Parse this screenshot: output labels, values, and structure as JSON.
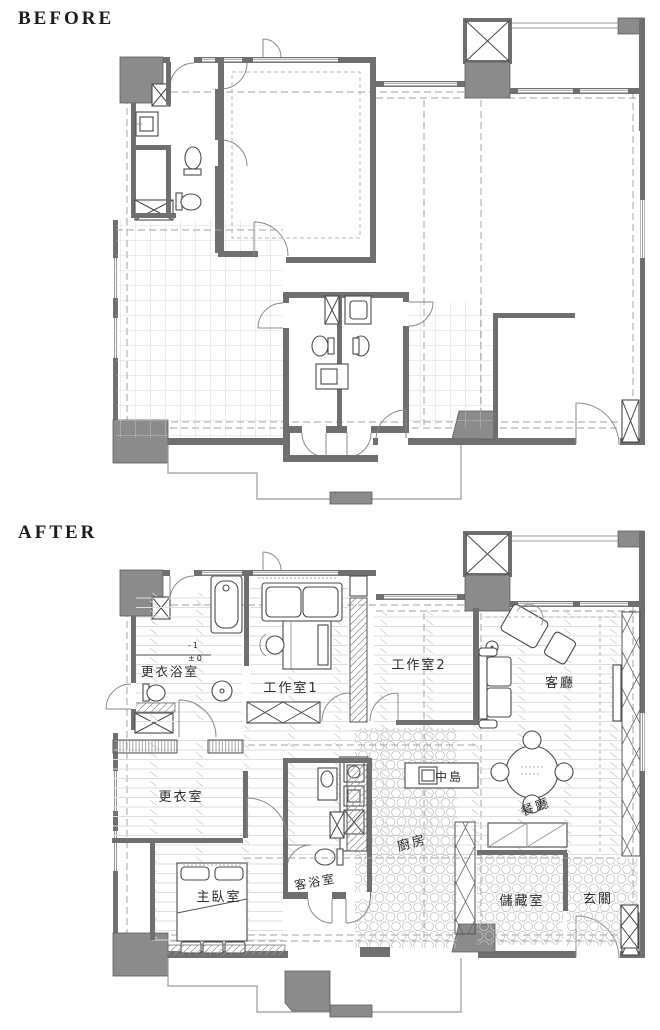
{
  "titles": {
    "before": "BEFORE",
    "after": "AFTER"
  },
  "after_plan": {
    "room_labels": [
      {
        "id": "dressing-bathroom",
        "label": "更衣浴室",
        "x": 170,
        "y": 676,
        "size": 12.5
      },
      {
        "id": "studio-1",
        "label": "工作室1",
        "x": 291,
        "y": 692,
        "size": 13
      },
      {
        "id": "studio-2",
        "label": "工作室2",
        "x": 419,
        "y": 669,
        "size": 13
      },
      {
        "id": "living-room",
        "label": "客廳",
        "x": 560,
        "y": 687,
        "size": 13
      },
      {
        "id": "dressing-room",
        "label": "更衣室",
        "x": 181,
        "y": 801,
        "size": 13
      },
      {
        "id": "island",
        "label": "中島",
        "x": 449,
        "y": 781,
        "size": 12
      },
      {
        "id": "dining-room",
        "label": "餐廳",
        "x": 537,
        "y": 811,
        "size": 13,
        "rotate": -20
      },
      {
        "id": "kitchen",
        "label": "廚房",
        "x": 413,
        "y": 847,
        "size": 13,
        "rotate": -15
      },
      {
        "id": "master-bedroom",
        "label": "主臥室",
        "x": 219,
        "y": 901,
        "size": 13
      },
      {
        "id": "guest-bathroom",
        "label": "客浴室",
        "x": 316,
        "y": 886,
        "size": 12,
        "rotate": -10
      },
      {
        "id": "storage-room",
        "label": "儲藏室",
        "x": 522,
        "y": 905,
        "size": 13
      },
      {
        "id": "entrance",
        "label": "玄關",
        "x": 598,
        "y": 903,
        "size": 13
      }
    ],
    "level_markers": [
      {
        "id": "level-minus-1",
        "label": "-1",
        "x": 194,
        "y": 648,
        "size": 8
      },
      {
        "id": "level-zero",
        "label": "±0",
        "x": 196,
        "y": 661,
        "size": 8
      }
    ]
  },
  "colors": {
    "wall": "#6f6f6f",
    "block": "#8b8b8b",
    "line": "#555555",
    "dashed": "#a3a3a3",
    "floor_line": "#dcdcdc",
    "label": "#2b2b2b",
    "bg": "#ffffff"
  }
}
